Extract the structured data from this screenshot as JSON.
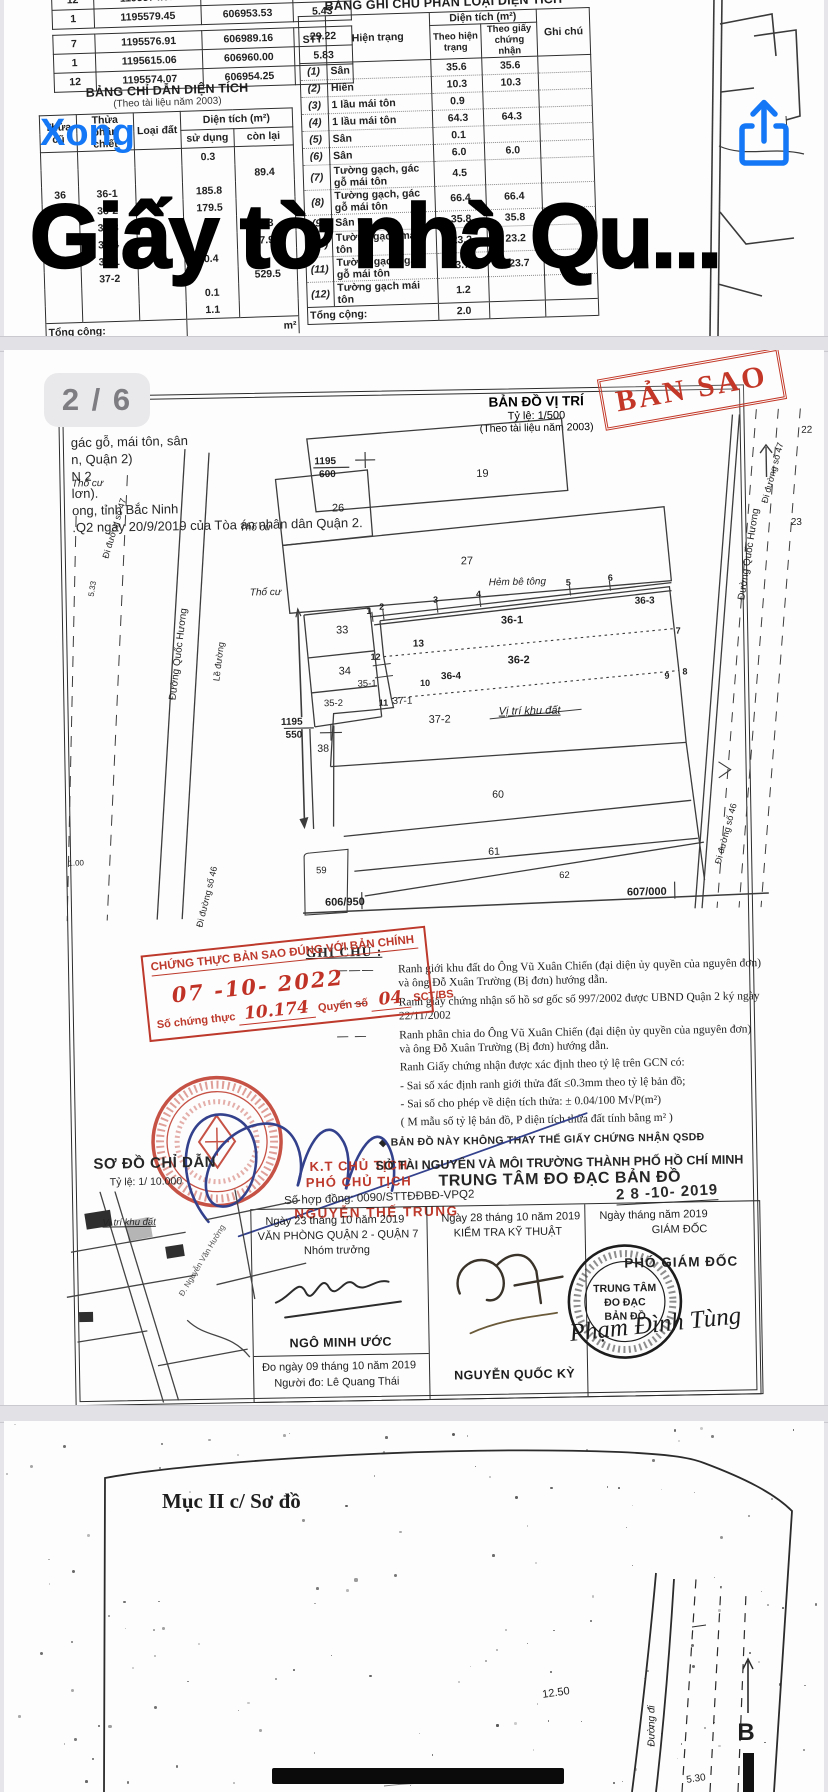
{
  "viewer": {
    "done_label": "Xong",
    "title_overlay": "Giấy tờ nhà Qu...",
    "page_indicator": "2 / 6",
    "accent_color": "#1478F6",
    "icons": {
      "share": "share-icon",
      "north": "north-arrow-icon"
    }
  },
  "top_page": {
    "coord_table": {
      "rows_a": [
        [
          "11",
          "1195568.69",
          "606954.98",
          ""
        ],
        [
          "12",
          "1195574.07",
          "606954.25",
          "5.43"
        ],
        [
          "1",
          "1195579.45",
          "606953.53",
          "5.43"
        ]
      ],
      "rows_b": [
        [
          "7",
          "1195576.91",
          "606989.16",
          "29.22"
        ],
        [
          "1",
          "1195615.06",
          "606960.00",
          "5.83"
        ],
        [
          "12",
          "1195574.07",
          "606954.25",
          ""
        ]
      ]
    },
    "area_table": {
      "title": "BẢNG CHỈ DẪN DIỆN TÍCH",
      "subtitle": "(Theo tài liệu năm 2003)",
      "col_thua_cu": "Thửa cũ",
      "col_thua_pc": "Thửa phân chiết",
      "col_loai_dat": "Loại đất",
      "col_dien_tich": "Diện tích (m²)",
      "col_su_dung": "sử dụng",
      "col_con_lai": "còn lại",
      "rows": [
        [
          "",
          "",
          "",
          "0.3",
          ""
        ],
        [
          "",
          "",
          "",
          "",
          "89.4"
        ],
        [
          "36",
          "36-1",
          "",
          "185.8",
          ""
        ],
        [
          "",
          "36-2",
          "",
          "179.5",
          ""
        ],
        [
          "",
          "36-3",
          "",
          "",
          "0.3"
        ],
        [
          "",
          "36-4",
          "",
          "",
          "7.9"
        ],
        [
          "37",
          "37-1",
          "",
          "0.4",
          ""
        ],
        [
          "",
          "37-2",
          "",
          "",
          "529.5"
        ],
        [
          "",
          "",
          "",
          "0.1",
          ""
        ],
        [
          "",
          "",
          "",
          "1.1",
          ""
        ]
      ],
      "total_label": "Tổng cộng:",
      "total_unit": "m²"
    },
    "note_table": {
      "title": "BẢNG GHI CHÚ PHÂN LOẠI DIỆN TÍCH",
      "col_stt": "STT",
      "col_hien_trang": "Hiện trạng",
      "col_dien_tich": "Diện tích (m²)",
      "col_theo_ht": "Theo hiện trạng",
      "col_theo_gcn": "Theo giấy chứng nhận",
      "col_ghi_chu": "Ghi chú",
      "rows": [
        [
          "(1)",
          "Sân",
          "35.6",
          "35.6"
        ],
        [
          "(2)",
          "Hiên",
          "10.3",
          "10.3"
        ],
        [
          "(3)",
          "1 lầu mái tôn",
          "0.9",
          ""
        ],
        [
          "(4)",
          "1 lầu mái tôn",
          "64.3",
          "64.3"
        ],
        [
          "(5)",
          "Sân",
          "0.1",
          ""
        ],
        [
          "(6)",
          "Sân",
          "6.0",
          "6.0"
        ],
        [
          "(7)",
          "Tường gạch, gác gỗ mái tôn",
          "4.5",
          ""
        ],
        [
          "(8)",
          "Tường gạch, gác gỗ mái tôn",
          "66.4",
          "66.4"
        ],
        [
          "(9)",
          "Sân",
          "35.8",
          "35.8"
        ],
        [
          "(10)",
          "Tường gạch mái tôn",
          "23.2",
          "23.2"
        ],
        [
          "(11)",
          "Tường gạch, gác gỗ mái tôn",
          "3.7",
          "123.7"
        ],
        [
          "(12)",
          "Tường gạch mái tôn",
          "1.2",
          ""
        ]
      ],
      "total_label": "Tổng cộng:",
      "total_value": "2.0"
    }
  },
  "mid_page": {
    "fragments": [
      "gác gỗ, mái tôn, sân",
      "n, Quận 2)",
      "N 2",
      "lơn).",
      "ong, tỉnh Bắc Ninh",
      ".Q2 ngày 20/9/2019 của Tòa án nhân dân Quận 2."
    ],
    "map": {
      "title": "BẢN ĐỒ VỊ TRÍ",
      "scale": "Tỷ lệ: 1/500",
      "source": "(Theo tài liệu năm 2003)",
      "copy_stamp": "BẢN SAO",
      "labels": [
        {
          "t": "19",
          "x": 425,
          "y": 60,
          "s": 11
        },
        {
          "t": "26",
          "x": 280,
          "y": 92,
          "s": 11
        },
        {
          "t": "27",
          "x": 408,
          "y": 147,
          "s": 11
        },
        {
          "t": "Hẻm bê tông",
          "x": 458,
          "y": 169,
          "s": 10,
          "i": 1
        },
        {
          "t": "36-1",
          "x": 452,
          "y": 207,
          "s": 11,
          "b": 1
        },
        {
          "t": "36-3",
          "x": 585,
          "y": 190,
          "s": 10,
          "b": 1
        },
        {
          "t": "36-2",
          "x": 458,
          "y": 247,
          "s": 11,
          "b": 1
        },
        {
          "t": "36-4",
          "x": 390,
          "y": 262,
          "s": 10,
          "b": 1
        },
        {
          "t": "37-1",
          "x": 341,
          "y": 286,
          "s": 10
        },
        {
          "t": "37-2",
          "x": 378,
          "y": 305,
          "s": 11
        },
        {
          "t": "Vị trí khu đất",
          "x": 468,
          "y": 298,
          "s": 11,
          "i": 1,
          "u": 1
        },
        {
          "t": "33",
          "x": 282,
          "y": 214,
          "s": 11
        },
        {
          "t": "34",
          "x": 284,
          "y": 255,
          "s": 11
        },
        {
          "t": "35-1",
          "x": 306,
          "y": 268,
          "s": 9.5
        },
        {
          "t": "35-2",
          "x": 272,
          "y": 287,
          "s": 9.5
        },
        {
          "t": "38",
          "x": 261,
          "y": 332,
          "s": 10.5
        },
        {
          "t": "60",
          "x": 435,
          "y": 381,
          "s": 10.5
        },
        {
          "t": "61",
          "x": 430,
          "y": 438,
          "s": 10.5
        },
        {
          "t": "62",
          "x": 500,
          "y": 463,
          "s": 9.5
        },
        {
          "t": "59",
          "x": 257,
          "y": 454,
          "s": 9.5
        },
        {
          "t": "Thổ cư",
          "x": 197,
          "y": 110,
          "s": 10,
          "i": 1
        },
        {
          "t": "Thổ cư",
          "x": 206,
          "y": 175,
          "s": 10,
          "i": 1
        },
        {
          "t": "Thổ cư",
          "x": 30,
          "y": 63,
          "s": 10,
          "i": 1
        },
        {
          "t": "1195",
          "x": 268,
          "y": 45,
          "s": 10,
          "b": 1
        },
        {
          "t": "600",
          "x": 270,
          "y": 58,
          "s": 10,
          "b": 1
        },
        {
          "t": "1195",
          "x": 230,
          "y": 305,
          "s": 10,
          "b": 1
        },
        {
          "t": "550",
          "x": 232,
          "y": 318,
          "s": 10,
          "b": 1
        },
        {
          "t": "606/950",
          "x": 280,
          "y": 486,
          "s": 11,
          "b": 1
        },
        {
          "t": "607/000",
          "x": 582,
          "y": 481,
          "s": 11,
          "b": 1
        },
        {
          "t": "Đường Quốc Hương",
          "x": 118,
          "y": 235,
          "s": 10,
          "r": -82
        },
        {
          "t": "Lề đường",
          "x": 158,
          "y": 243,
          "s": 9,
          "r": -82
        },
        {
          "t": "Đi đường số 47",
          "x": 56,
          "y": 108,
          "s": 9,
          "r": -72
        },
        {
          "t": "Đi đường số 46",
          "x": 142,
          "y": 478,
          "s": 9,
          "r": -75
        },
        {
          "t": "5.33",
          "x": 33,
          "y": 168,
          "s": 8,
          "r": -80
        },
        {
          "t": "1.00",
          "x": 12,
          "y": 442,
          "s": 8
        },
        {
          "t": "Đường Quốc Hương",
          "x": 690,
          "y": 145,
          "s": 10,
          "r": -80
        },
        {
          "t": "Đi đường số 47",
          "x": 715,
          "y": 64,
          "s": 9,
          "r": -74
        },
        {
          "t": "Đi đường số 46",
          "x": 662,
          "y": 424,
          "s": 9,
          "r": -74
        },
        {
          "t": "22",
          "x": 750,
          "y": 22,
          "s": 10
        },
        {
          "t": "23",
          "x": 738,
          "y": 114,
          "s": 10
        },
        {
          "t": "1",
          "x": 309,
          "y": 195,
          "s": 9,
          "b": 1
        },
        {
          "t": "2",
          "x": 322,
          "y": 191,
          "s": 9,
          "b": 1
        },
        {
          "t": "3",
          "x": 376,
          "y": 185,
          "s": 9,
          "b": 1
        },
        {
          "t": "4",
          "x": 419,
          "y": 180,
          "s": 9,
          "b": 1
        },
        {
          "t": "5",
          "x": 509,
          "y": 170,
          "s": 9,
          "b": 1
        },
        {
          "t": "6",
          "x": 551,
          "y": 166,
          "s": 9,
          "b": 1
        },
        {
          "t": "7",
          "x": 618,
          "y": 220,
          "s": 9,
          "b": 1
        },
        {
          "t": "8",
          "x": 624,
          "y": 261,
          "s": 9,
          "b": 1
        },
        {
          "t": "9",
          "x": 606,
          "y": 265,
          "s": 9,
          "b": 1
        },
        {
          "t": "10",
          "x": 364,
          "y": 268,
          "s": 9,
          "b": 1
        },
        {
          "t": "11",
          "x": 322,
          "y": 287,
          "s": 9,
          "b": 1
        },
        {
          "t": "12",
          "x": 315,
          "y": 241,
          "s": 9,
          "b": 1
        },
        {
          "t": "13",
          "x": 358,
          "y": 229,
          "s": 10,
          "b": 1
        }
      ]
    },
    "ghi_chu": {
      "title": "GHI CHÚ :",
      "items": [
        {
          "sym": "solid",
          "text": "Ranh giới khu đất do Ông Vũ Xuân Chiến (đại diện ủy quyền của nguyên đơn) và ông Đỗ Xuân Trường (Bị đơn) hướng dẫn."
        },
        {
          "sym": "dash",
          "text": "Ranh giấy chứng nhận số hồ sơ gốc số 997/2002 được UBND Quận 2 ký ngày 22/11/2002"
        },
        {
          "sym": "dash",
          "text": "Ranh phân chia do Ông Vũ Xuân Chiến (đại diện ủy quyền của nguyên đơn) và ông Đỗ Xuân Trường (Bị đơn) hướng dẫn."
        },
        {
          "sym": "none",
          "text": "Ranh Giấy chứng nhận được xác định theo tỷ lệ trên GCN có:"
        },
        {
          "sym": "none",
          "text": "- Sai số xác định ranh giới thửa đất ≤0.3mm theo tỷ lệ bản đồ;"
        },
        {
          "sym": "none",
          "text": "- Sai số cho phép về diện tích thửa: ± 0.04/100 M√P(m²)"
        },
        {
          "sym": "none",
          "text": "( M mẫu số tỷ lệ bản đồ, P diện tích thửa đất tính bằng m² )"
        }
      ],
      "disclaimer": "◆ BẢN ĐỒ NÀY KHÔNG THAY THẾ GIẤY CHỨNG NHẬN QSDĐ"
    },
    "cert_stamp": {
      "line1": "CHỨNG THỰC BẢN SAO ĐÚNG VỚI BẢN CHÍNH",
      "date": "07 -10- 2022",
      "prefix": "Số chứng thực",
      "number": "10.174",
      "mid": "Quyển số",
      "book": "04",
      "suffix": "SCT/BS"
    },
    "approval": {
      "kt": "K.T CHỦ TỊCH",
      "pho": "PHÓ CHỦ TỊCH",
      "contract": "Số hợp đồng: 0090/STTĐĐBĐ-VPQ2",
      "signer": "NGUYỄN THẾ TRUNG",
      "dept_line1": "SỞ TÀI NGUYÊN VÀ MÔI TRƯỜNG THÀNH PHỐ HỒ CHÍ MINH",
      "dept_line2": "TRUNG TÂM ĐO ĐẠC BẢN ĐỒ",
      "date_stamp": "2 8  -10-  2019",
      "col1": {
        "date": "Ngày 23 tháng 10 năm 2019",
        "office": "VĂN PHÒNG QUẬN 2 - QUẬN 7",
        "role": "Nhóm trưởng",
        "name": "NGÔ MINH ƯỚC",
        "measured": "Đo ngày 09  tháng 10 năm  2019",
        "measurer": "Người đo: Lê Quang Thái"
      },
      "col2": {
        "date": "Ngày 28 tháng 10 năm 2019",
        "role": "KIỂM TRA KỸ THUẬT",
        "name": "NGUYỄN QUỐC KỲ"
      },
      "col3": {
        "date": "Ngày      tháng      năm 2019",
        "role": "GIÁM ĐỐC",
        "title2": "PHÓ GIÁM ĐỐC",
        "stamp_l1": "TRUNG TÂM",
        "stamp_l2": "ĐO ĐẠC",
        "stamp_l3": "BẢN ĐỒ",
        "script_name": "Phạm Đình Tùng"
      }
    },
    "mini_map": {
      "title": "SƠ ĐỒ CHỈ DẪN",
      "scale": "Tỷ lệ: 1/ 10.000",
      "site": "Vị trí khu đất",
      "street": "Đ. Nguyễn Văn Hưởng"
    }
  },
  "bottom_page": {
    "section": "Mục II c/ Sơ đồ",
    "labels": [
      {
        "t": "12.50",
        "x": 552,
        "y": 272,
        "s": 11,
        "r": -8
      },
      {
        "t": "5.30",
        "x": 692,
        "y": 358,
        "s": 10,
        "r": -8
      },
      {
        "t": "Đường đi",
        "x": 648,
        "y": 305,
        "s": 10,
        "r": -90,
        "i": 1
      },
      {
        "t": "B",
        "x": 742,
        "y": 312,
        "s": 24,
        "b": 1
      }
    ]
  }
}
